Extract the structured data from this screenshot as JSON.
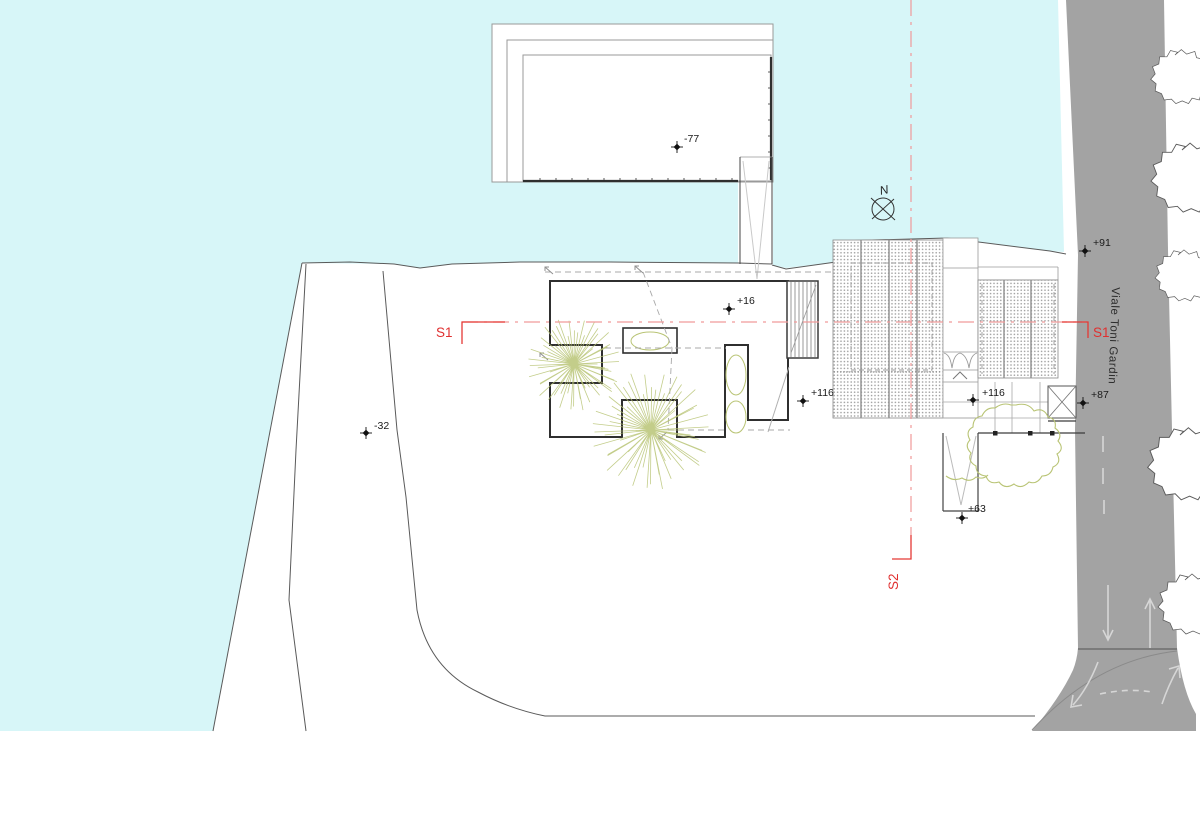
{
  "labels": {
    "street": "Viale Toni Gardin",
    "north": "N",
    "s1": "S1",
    "s2": "S2"
  },
  "markers": [
    {
      "name": "elevation--77",
      "label": "-77"
    },
    {
      "name": "elevation-+16",
      "label": "+16"
    },
    {
      "name": "elevation--32",
      "label": "-32"
    },
    {
      "name": "elevation-+116-west",
      "label": "+116"
    },
    {
      "name": "elevation-+116-east",
      "label": "+116"
    },
    {
      "name": "elevation-+91",
      "label": "+91"
    },
    {
      "name": "elevation-+87",
      "label": "+87"
    },
    {
      "name": "elevation-+63",
      "label": "+63"
    }
  ],
  "colors": {
    "water": "#d7f6f8",
    "road": "#a3a3a3",
    "tree": "#b9c475",
    "section_line": "#f09a9a",
    "section_label": "#e03030",
    "wall": "#2f2f2f"
  }
}
